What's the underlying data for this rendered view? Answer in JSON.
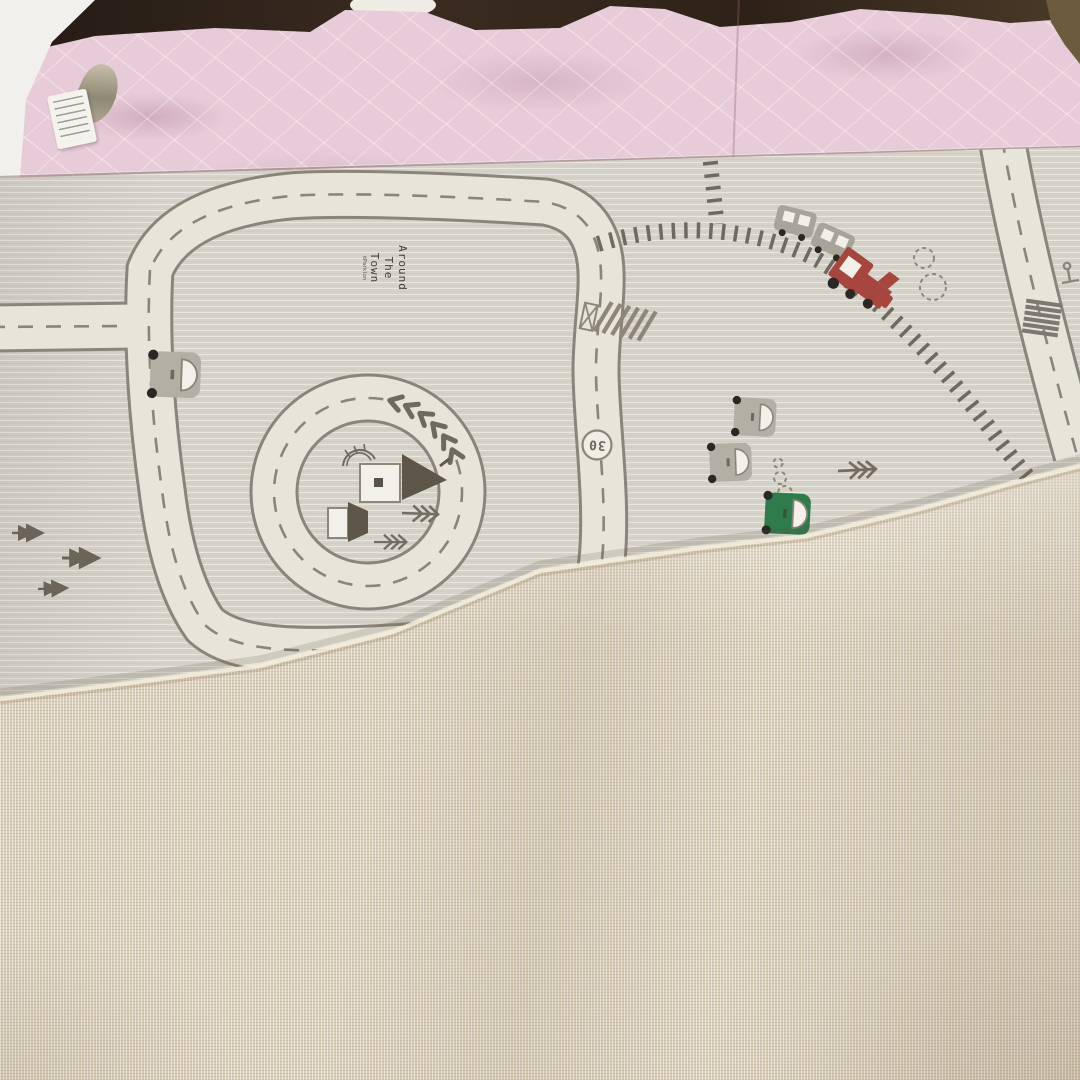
{
  "scene": {
    "type": "photograph",
    "description": "A foldable baby play mat lying on a bed with a pink quilted bedspread; the mat's printed town-road side is partly folded over, showing its beige linen-textured backing."
  },
  "bed": {
    "bedspread_label": "pink quilted bedspread",
    "sheet_label": "white sheet",
    "care_tag_label": "fabric care tag"
  },
  "mat": {
    "title": {
      "line1": "Around",
      "line2": "The",
      "line3": "Town"
    },
    "credit": "©Parklon",
    "speed_sign": "30",
    "front_label": "town road-map print side",
    "back_label": "beige woven backing side"
  },
  "colors": {
    "mat_base": "#d6d2c8",
    "road_fill": "#e7e4da",
    "road_edge": "#8b8579",
    "rail": "#6f6a60",
    "pine": "#6b6459",
    "house_roof": "#5f564a",
    "train_red": "#a6463e",
    "car_gray": "#b4afa4",
    "car_green": "#2f7b4c",
    "quilt_pink": "#e7cbd8",
    "fold_beige": "#dacfbb",
    "dark_gap": "#2b211a"
  }
}
